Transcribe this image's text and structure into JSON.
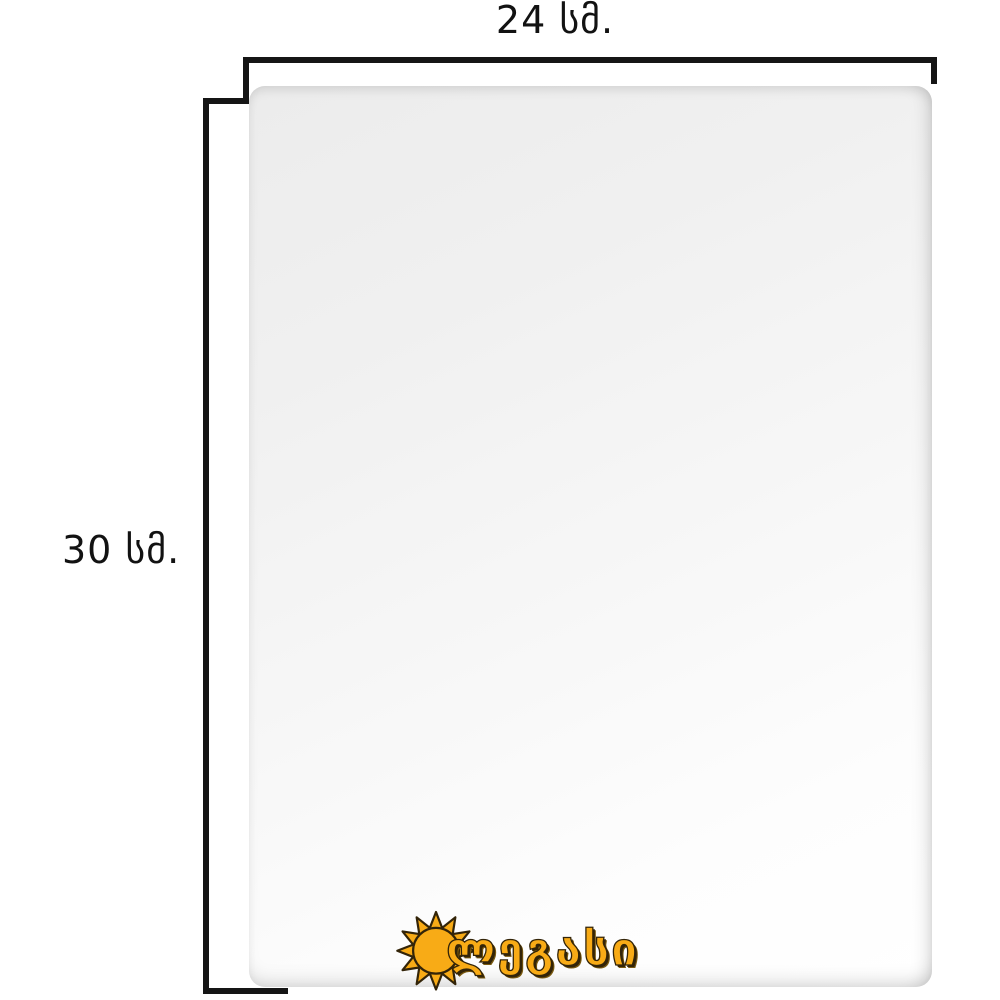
{
  "page": {
    "background_color": "#ffffff",
    "description_visible_content": "product dimension diagram of a blank white canvas panel"
  },
  "dimensions": {
    "width_label": "24 სმ.",
    "height_label": "30 სმ.",
    "bracket_color": "#151515",
    "label_color": "#121212"
  },
  "product": {
    "panel_face_color": "#f7f7f7",
    "panel_edge_shadow_color": "#e8e8e8"
  },
  "brand": {
    "logo_text": "ლეგასი",
    "icon": "sun-icon",
    "logo_fill_color": "#f8ab16",
    "logo_outline_color": "#332408",
    "logo_shadow_color": "#7a5a10"
  }
}
